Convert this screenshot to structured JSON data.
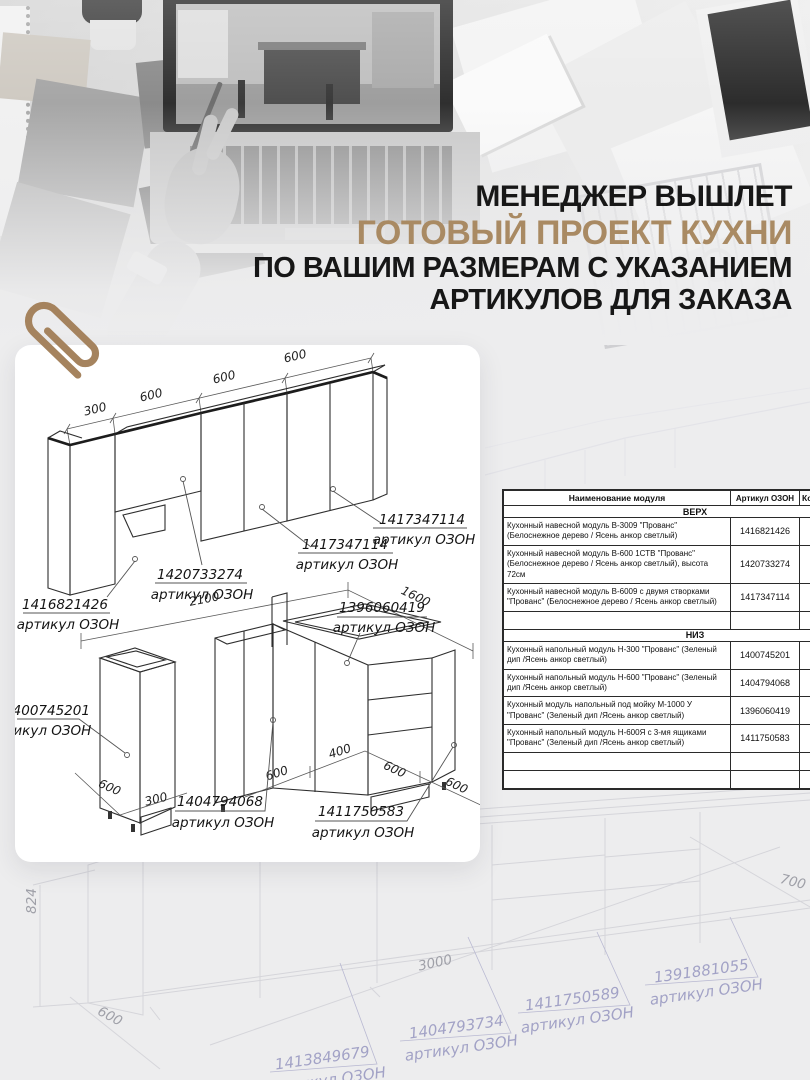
{
  "headline": {
    "line1": "МЕНЕДЖЕР ВЫШЛЕТ",
    "line2": "ГОТОВЫЙ ПРОЕКТ КУХНИ",
    "line3": "ПО ВАШИМ РАЗМЕРАМ С УКАЗАНИЕМ",
    "line4": "АРТИКУЛОВ ДЛЯ ЗАКАЗА",
    "accent_color": "#a98a63",
    "text_color": "#171717"
  },
  "card": {
    "top_drawing": {
      "dims": [
        "300",
        "600",
        "600",
        "600"
      ],
      "labels": [
        {
          "article": "1416821426",
          "caption": "артикул ОЗОН"
        },
        {
          "article": "1420733274",
          "caption": "артикул ОЗОН"
        },
        {
          "article": "1417347114",
          "caption": "артикул ОЗОН"
        },
        {
          "article": "1417347114",
          "caption": "артикул ОЗОН"
        }
      ]
    },
    "bottom_drawing": {
      "dims": {
        "total": "2100",
        "right_run": "1600",
        "left_depth": "600",
        "left_width": "300",
        "front1": "600",
        "front2": "400",
        "front3": "600",
        "right_depth": "600"
      },
      "labels": [
        {
          "article": "1400745201",
          "caption": "артикул ОЗОН"
        },
        {
          "article": "1404794068",
          "caption": "артикул ОЗОН"
        },
        {
          "article": "1396060419",
          "caption": "артикул ОЗОН"
        },
        {
          "article": "1411750583",
          "caption": "артикул ОЗОН"
        }
      ]
    }
  },
  "spec_table": {
    "header": {
      "name": "Наименование модуля",
      "article": "Артикул ОЗОН",
      "qty": "Кол-во"
    },
    "section_top": {
      "title": "ВЕРХ",
      "rows": [
        {
          "name": "Кухонный навесной модуль В-3009 \"Прованс\" (Белоснежное дерево / Ясень анкор светлый)",
          "article": "1416821426"
        },
        {
          "name": "Кухонный навесной модуль В-600 1СТВ \"Прованс\" (Белоснежное дерево / Ясень анкор светлый), высота 72см",
          "article": "1420733274"
        },
        {
          "name": "Кухонный навесной модуль В-6009 с двумя створками \"Прованс\" (Белоснежное дерево / Ясень анкор светлый)",
          "article": "1417347114"
        }
      ]
    },
    "section_bottom": {
      "title": "НИЗ",
      "rows": [
        {
          "name": "Кухонный напольный модуль Н-300 \"Прованс\" (Зеленый дип /Ясень анкор светлый)",
          "article": "1400745201"
        },
        {
          "name": "Кухонный напольный модуль Н-600 \"Прованс\" (Зеленый дип /Ясень анкор светлый)",
          "article": "1404794068"
        },
        {
          "name": "Кухонный модуль напольный под мойку М-1000 У \"Прованс\" (Зеленый дип /Ясень анкор светлый)",
          "article": "1396060419"
        },
        {
          "name": "Кухонный напольный модуль Н-600Я с 3-мя ящиками \"Прованс\" (Зеленый дип /Ясень анкор светлый)",
          "article": "1411750583"
        }
      ]
    }
  },
  "faded_plan": {
    "dims": {
      "height": "824",
      "depth": "600",
      "length": "3000",
      "right": "700"
    },
    "labels": [
      {
        "article": "1413849679",
        "caption": "артикул ОЗОН"
      },
      {
        "article": "1404793734",
        "caption": "артикул ОЗОН"
      },
      {
        "article": "1411750589",
        "caption": "артикул ОЗОН"
      },
      {
        "article": "1391881055",
        "caption": "артикул ОЗОН"
      }
    ]
  }
}
